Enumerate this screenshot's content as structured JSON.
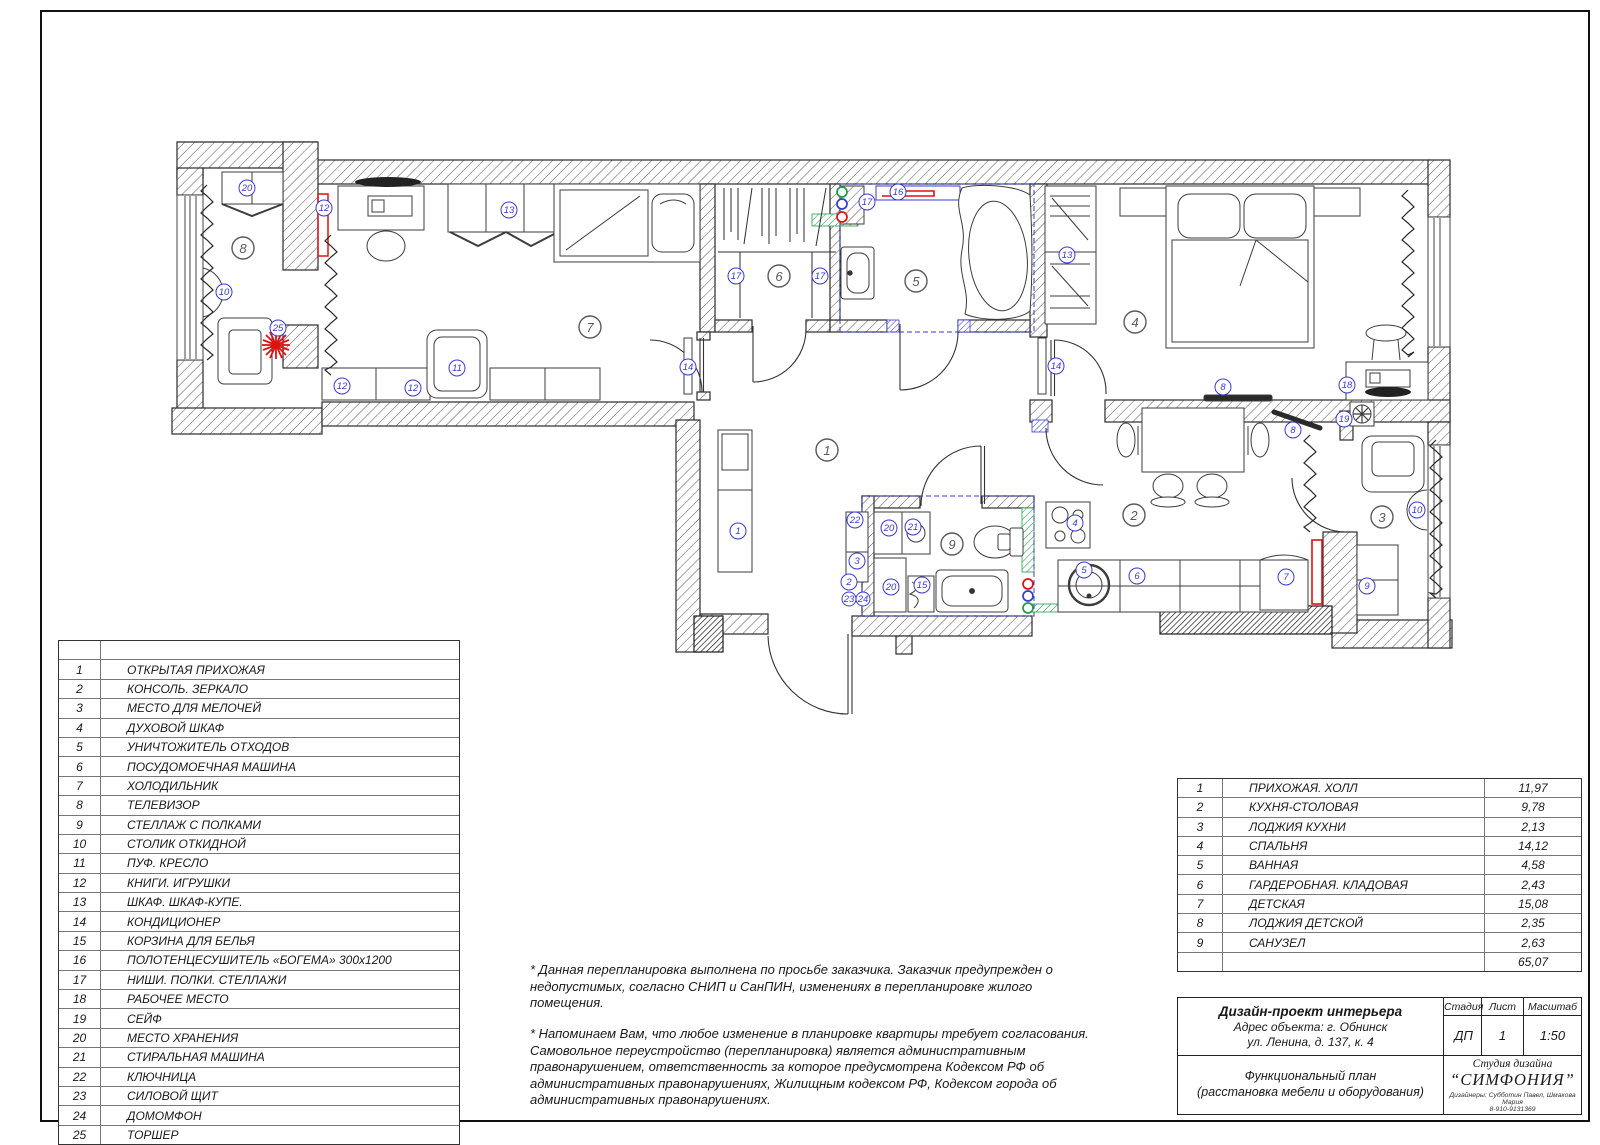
{
  "legend": {
    "items": [
      {
        "num": "1",
        "label": "ОТКРЫТАЯ ПРИХОЖАЯ"
      },
      {
        "num": "2",
        "label": "КОНСОЛЬ. ЗЕРКАЛО"
      },
      {
        "num": "3",
        "label": "МЕСТО ДЛЯ МЕЛОЧЕЙ"
      },
      {
        "num": "4",
        "label": "ДУХОВОЙ ШКАФ"
      },
      {
        "num": "5",
        "label": "УНИЧТОЖИТЕЛЬ ОТХОДОВ"
      },
      {
        "num": "6",
        "label": "ПОСУДОМОЕЧНАЯ МАШИНА"
      },
      {
        "num": "7",
        "label": "ХОЛОДИЛЬНИК"
      },
      {
        "num": "8",
        "label": "ТЕЛЕВИЗОР"
      },
      {
        "num": "9",
        "label": "СТЕЛЛАЖ С ПОЛКАМИ"
      },
      {
        "num": "10",
        "label": "СТОЛИК ОТКИДНОЙ"
      },
      {
        "num": "11",
        "label": "ПУФ. КРЕСЛО"
      },
      {
        "num": "12",
        "label": "КНИГИ. ИГРУШКИ"
      },
      {
        "num": "13",
        "label": "ШКАФ. ШКАФ-КУПЕ."
      },
      {
        "num": "14",
        "label": "КОНДИЦИОНЕР"
      },
      {
        "num": "15",
        "label": "КОРЗИНА ДЛЯ БЕЛЬЯ"
      },
      {
        "num": "16",
        "label": "ПОЛОТЕНЦЕСУШИТЕЛЬ «БОГЕМА» 300х1200"
      },
      {
        "num": "17",
        "label": "НИШИ. ПОЛКИ. СТЕЛЛАЖИ"
      },
      {
        "num": "18",
        "label": "РАБОЧЕЕ МЕСТО"
      },
      {
        "num": "19",
        "label": "СЕЙФ"
      },
      {
        "num": "20",
        "label": "МЕСТО ХРАНЕНИЯ"
      },
      {
        "num": "21",
        "label": "СТИРАЛЬНАЯ МАШИНА"
      },
      {
        "num": "22",
        "label": "КЛЮЧНИЦА"
      },
      {
        "num": "23",
        "label": "СИЛОВОЙ ЩИТ"
      },
      {
        "num": "24",
        "label": "ДОМОМФОН"
      },
      {
        "num": "25",
        "label": "ТОРШЕР"
      }
    ]
  },
  "rooms": {
    "items": [
      {
        "num": "1",
        "name": "ПРИХОЖАЯ. ХОЛЛ",
        "area": "11,97"
      },
      {
        "num": "2",
        "name": "КУХНЯ-СТОЛОВАЯ",
        "area": "9,78"
      },
      {
        "num": "3",
        "name": "ЛОДЖИЯ КУХНИ",
        "area": "2,13"
      },
      {
        "num": "4",
        "name": "СПАЛЬНЯ",
        "area": "14,12"
      },
      {
        "num": "5",
        "name": "ВАННАЯ",
        "area": "4,58"
      },
      {
        "num": "6",
        "name": "ГАРДЕРОБНАЯ. КЛАДОВАЯ",
        "area": "2,43"
      },
      {
        "num": "7",
        "name": "ДЕТСКАЯ",
        "area": "15,08"
      },
      {
        "num": "8",
        "name": "ЛОДЖИЯ ДЕТСКОЙ",
        "area": "2,35"
      },
      {
        "num": "9",
        "name": "САНУЗЕЛ",
        "area": "2,63"
      }
    ],
    "total": "65,07"
  },
  "notes": {
    "p1": "* Данная перепланировка выполнена по просьбе заказчика. Заказчик предупрежден о недопустимых, согласно СНИП и СанПИН, изменениях в перепланировке жилого помещения.",
    "p2": "* Напоминаем Вам, что любое изменение в планировке квартиры требует согласования. Самовольное переустройство (перепланировка) является административным правонарушением, ответственность за которое предусмотрена Кодексом РФ об административных правонарушениях, Жилищным кодексом РФ, Кодексом города об административных правонарушениях."
  },
  "title_block": {
    "title": "Дизайн-проект интерьера",
    "address_line1": "Адрес объекта: г. Обнинск",
    "address_line2": "ул. Ленина, д. 137, к. 4",
    "stage_label": "Стадия",
    "sheet_label": "Лист",
    "scale_label": "Масштаб",
    "stage": "ДП",
    "sheet": "1",
    "scale": "1:50",
    "doc_line1": "Функциональный план",
    "doc_line2": "(расстановка мебели и оборудования)",
    "studio_label": "Студия дизайна",
    "studio_name": "“СИМФОНИЯ”",
    "designers": "Дизайнеры: Субботин Павел, Шмакова Мария",
    "phone": "8-910-9131369"
  },
  "plan": {
    "colors": {
      "item_marker_blue": "#3a3ad0",
      "room_marker_gray": "#5a5a5a",
      "accent_red": "#e01010",
      "accent_green": "#1f9d44",
      "wall_line": "#2a2a2a"
    },
    "room_markers": [
      {
        "n": "8",
        "x": 243,
        "y": 248
      },
      {
        "n": "7",
        "x": 590,
        "y": 327
      },
      {
        "n": "6",
        "x": 779,
        "y": 276
      },
      {
        "n": "5",
        "x": 916,
        "y": 281
      },
      {
        "n": "4",
        "x": 1135,
        "y": 322
      },
      {
        "n": "1",
        "x": 827,
        "y": 450
      },
      {
        "n": "9",
        "x": 952,
        "y": 544
      },
      {
        "n": "2",
        "x": 1134,
        "y": 515
      },
      {
        "n": "3",
        "x": 1382,
        "y": 517
      }
    ],
    "item_markers": [
      {
        "n": "20",
        "x": 247,
        "y": 188
      },
      {
        "n": "10",
        "x": 224,
        "y": 292
      },
      {
        "n": "25",
        "x": 278,
        "y": 328
      },
      {
        "n": "12",
        "x": 324,
        "y": 208
      },
      {
        "n": "13",
        "x": 509,
        "y": 210
      },
      {
        "n": "11",
        "x": 457,
        "y": 368
      },
      {
        "n": "12",
        "x": 342,
        "y": 386
      },
      {
        "n": "12",
        "x": 413,
        "y": 388
      },
      {
        "n": "17",
        "x": 736,
        "y": 276
      },
      {
        "n": "17",
        "x": 820,
        "y": 276
      },
      {
        "n": "14",
        "x": 688,
        "y": 367
      },
      {
        "n": "17",
        "x": 867,
        "y": 202
      },
      {
        "n": "16",
        "x": 898,
        "y": 192
      },
      {
        "n": "13",
        "x": 1067,
        "y": 255
      },
      {
        "n": "14",
        "x": 1056,
        "y": 366
      },
      {
        "n": "8",
        "x": 1223,
        "y": 387
      },
      {
        "n": "18",
        "x": 1347,
        "y": 385
      },
      {
        "n": "19",
        "x": 1344,
        "y": 419
      },
      {
        "n": "8",
        "x": 1293,
        "y": 430
      },
      {
        "n": "4",
        "x": 1075,
        "y": 523
      },
      {
        "n": "5",
        "x": 1084,
        "y": 570
      },
      {
        "n": "6",
        "x": 1137,
        "y": 576
      },
      {
        "n": "7",
        "x": 1286,
        "y": 577
      },
      {
        "n": "10",
        "x": 1417,
        "y": 510
      },
      {
        "n": "9",
        "x": 1367,
        "y": 586
      },
      {
        "n": "1",
        "x": 738,
        "y": 531
      },
      {
        "n": "22",
        "x": 855,
        "y": 520
      },
      {
        "n": "3",
        "x": 857,
        "y": 561
      },
      {
        "n": "2",
        "x": 849,
        "y": 582
      },
      {
        "n": "23",
        "x": 849,
        "y": 599
      },
      {
        "n": "24",
        "x": 863,
        "y": 599
      },
      {
        "n": "20",
        "x": 889,
        "y": 528
      },
      {
        "n": "21",
        "x": 913,
        "y": 527
      },
      {
        "n": "20",
        "x": 891,
        "y": 587
      },
      {
        "n": "15",
        "x": 922,
        "y": 585
      }
    ],
    "utility_dots": [
      {
        "c": "green",
        "x": 842,
        "y": 192
      },
      {
        "c": "blue",
        "x": 842,
        "y": 204
      },
      {
        "c": "red",
        "x": 842,
        "y": 217
      },
      {
        "c": "red",
        "x": 1028,
        "y": 584
      },
      {
        "c": "blue",
        "x": 1028,
        "y": 596
      },
      {
        "c": "green",
        "x": 1028,
        "y": 608
      }
    ]
  }
}
